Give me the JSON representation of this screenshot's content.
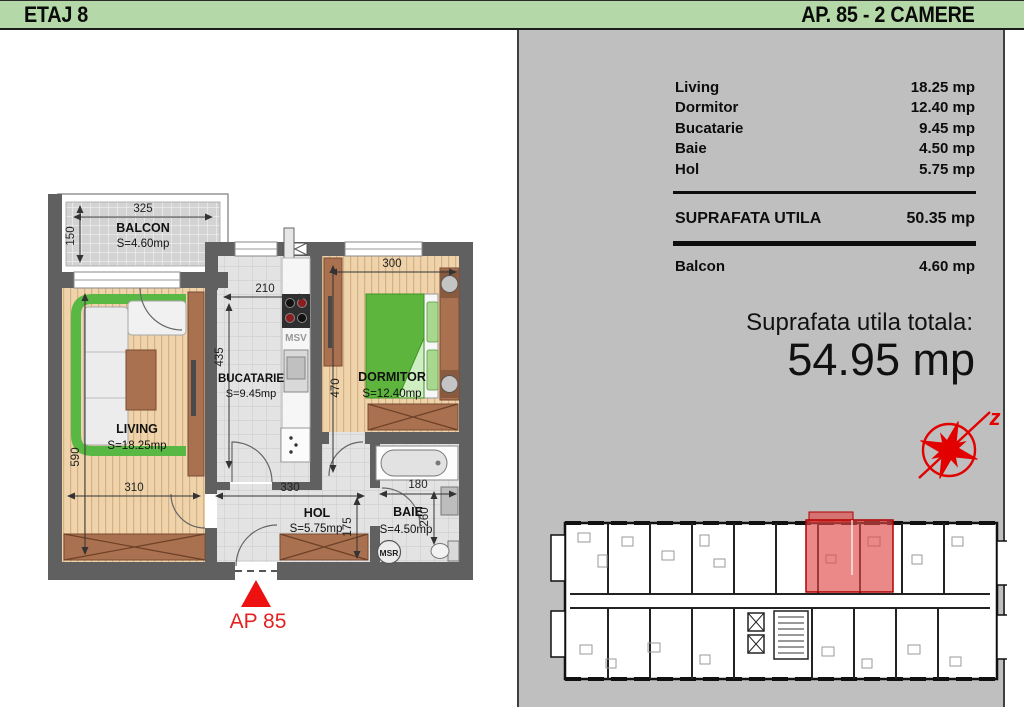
{
  "header": {
    "floor_label": "ETAJ 8",
    "apartment_label": "AP. 85 - 2 CAMERE"
  },
  "area_table": {
    "rows": [
      {
        "label": "Living",
        "value": "18.25 mp"
      },
      {
        "label": "Dormitor",
        "value": "12.40 mp"
      },
      {
        "label": "Bucatarie",
        "value": "9.45 mp"
      },
      {
        "label": "Baie",
        "value": "4.50 mp"
      },
      {
        "label": "Hol",
        "value": "5.75 mp"
      }
    ],
    "useful": {
      "label": "SUPRAFATA UTILA",
      "value": "50.35 mp"
    },
    "balcony": {
      "label": "Balcon",
      "value": "4.60 mp"
    },
    "total": {
      "label": "Suprafata utila totala:",
      "value": "54.95 mp"
    }
  },
  "floorplan": {
    "rooms": [
      {
        "name": "BALCON",
        "area": "S=4.60mp"
      },
      {
        "name": "LIVING",
        "area": "S=18.25mp"
      },
      {
        "name": "BUCATARIE",
        "area": "S=9.45mp"
      },
      {
        "name": "DORMITOR",
        "area": "S=12.40mp"
      },
      {
        "name": "HOL",
        "area": "S=5.75mp"
      },
      {
        "name": "BAIE",
        "area": "S=4.50mp"
      }
    ],
    "dims": {
      "balcony_width": "325",
      "balcony_depth": "150",
      "kitchen_width": "210",
      "kitchen_depth": "435",
      "bedroom_width": "300",
      "bedroom_depth": "470",
      "living_depth": "590",
      "living_width": "310",
      "hall_width": "330",
      "bath_width": "180",
      "hall_depth": "175",
      "bath_depth": "260"
    },
    "fixtures": {
      "msv": "MSV",
      "msr": "MSR"
    },
    "entrance_label": "AP 85",
    "compass_letter": "z"
  },
  "colors": {
    "header_green": "#b4d8a8",
    "panel_gray": "#bfbfbf",
    "wall_gray": "#606060",
    "accent_red": "#e01b1b",
    "wood": "#eed3ab",
    "furniture_brown": "#a9714f",
    "sofa_green": "#58b843"
  }
}
